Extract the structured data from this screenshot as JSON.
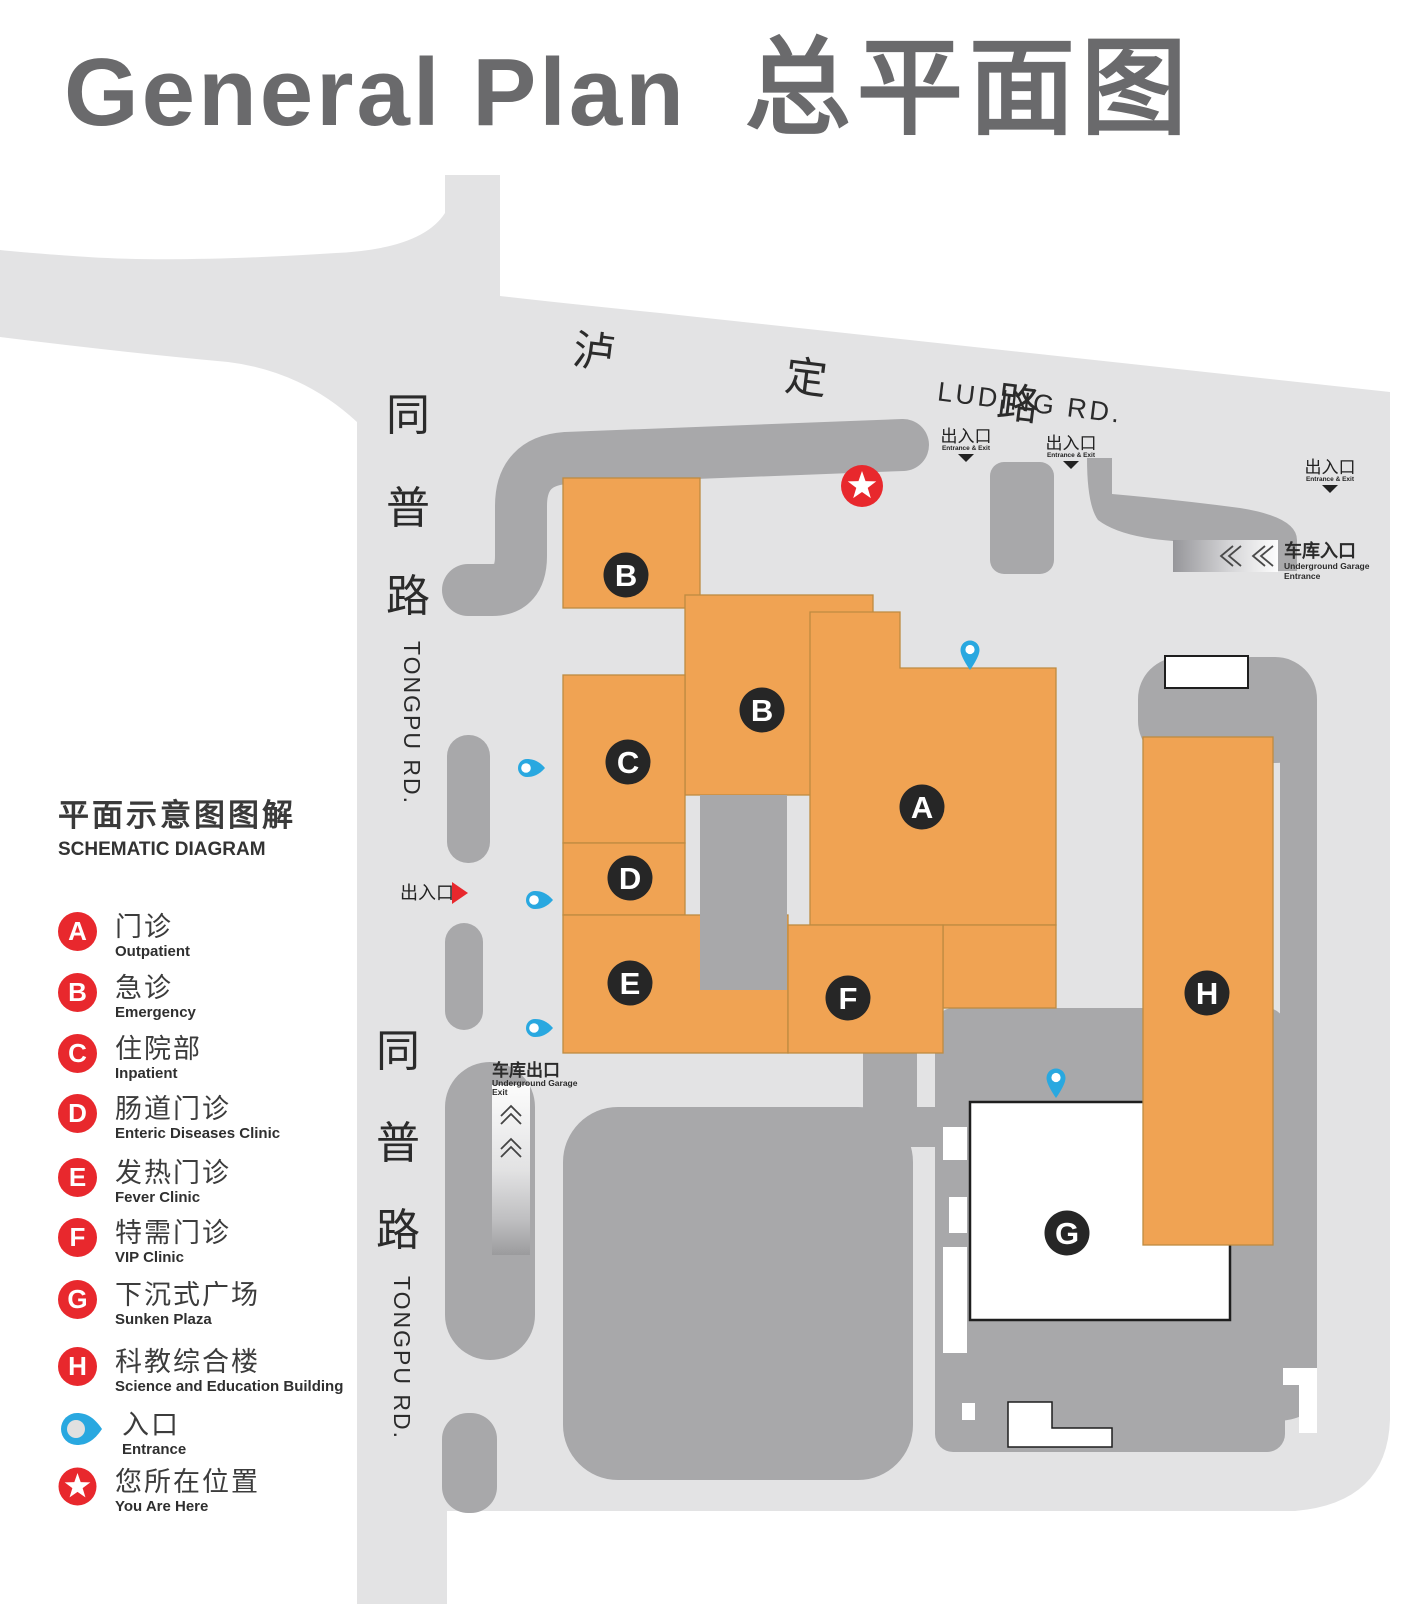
{
  "title": {
    "en": "General Plan",
    "zh": "总平面图"
  },
  "roads": {
    "luding_zh": "泸 定 路",
    "luding_en": "LUDING RD.",
    "tongpu_zh_1": "同",
    "tongpu_zh_2": "普",
    "tongpu_zh_3": "路",
    "tongpu_en": "TONGPU RD."
  },
  "markers": {
    "exit_zh": "出入口",
    "exit_en": "Entrance & Exit",
    "garage_in_zh": "车库入口",
    "garage_in_en1": "Underground Garage",
    "garage_in_en2": "Entrance",
    "garage_out_zh": "车库出口",
    "garage_out_en1": "Underground Garage",
    "garage_out_en2": "Exit"
  },
  "map": {
    "building_labels": [
      "B",
      "B",
      "C",
      "D",
      "E",
      "F",
      "A",
      "G",
      "H"
    ]
  },
  "legend": {
    "title_zh": "平面示意图图解",
    "title_en": "SCHEMATIC DIAGRAM",
    "items": [
      {
        "letter": "A",
        "zh": "门诊",
        "en": "Outpatient"
      },
      {
        "letter": "B",
        "zh": "急诊",
        "en": "Emergency"
      },
      {
        "letter": "C",
        "zh": "住院部",
        "en": "Inpatient"
      },
      {
        "letter": "D",
        "zh": "肠道门诊",
        "en": "Enteric Diseases Clinic"
      },
      {
        "letter": "E",
        "zh": "发热门诊",
        "en": "Fever Clinic"
      },
      {
        "letter": "F",
        "zh": "特需门诊",
        "en": "VIP Clinic"
      },
      {
        "letter": "G",
        "zh": "下沉式广场",
        "en": "Sunken Plaza"
      },
      {
        "letter": "H",
        "zh": "科教综合楼",
        "en": "Science and Education Building"
      },
      {
        "zh": "入口",
        "en": "Entrance"
      },
      {
        "zh": "您所在位置",
        "en": "You Are Here"
      }
    ]
  },
  "colors": {
    "building_orange": "#F0A353",
    "road_light": "#E3E3E4",
    "road_dark": "#A8A8AA",
    "accent_red": "#E8282D",
    "accent_blue": "#29A8E0",
    "ink": "#2B2B2B",
    "title_gray": "#6A6A6C"
  }
}
